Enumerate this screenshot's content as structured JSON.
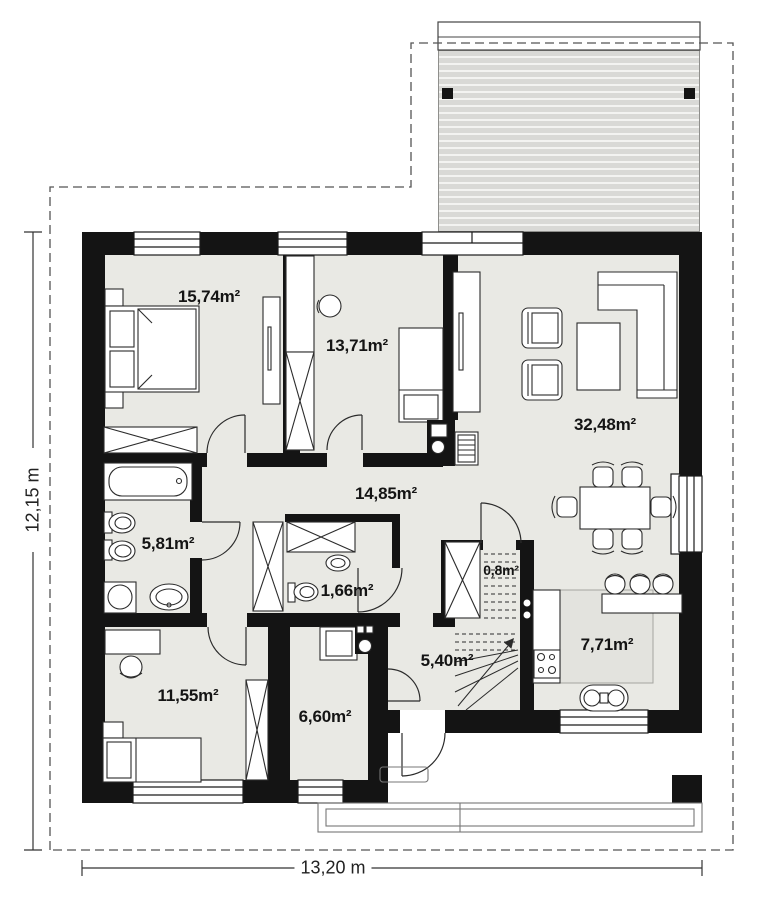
{
  "plan": {
    "type": "single-storey house floor plan",
    "total_rooms_labeled": 11
  },
  "dimensions": {
    "height": "12,15 m",
    "width": "13,20 m"
  },
  "rooms": [
    {
      "id": "bedroom-top-left",
      "area": "15,74m²"
    },
    {
      "id": "room-top-middle",
      "area": "13,71m²"
    },
    {
      "id": "living-room",
      "area": "32,48m²"
    },
    {
      "id": "hall",
      "area": "14,85m²"
    },
    {
      "id": "bathroom",
      "area": "5,81m²"
    },
    {
      "id": "wc",
      "area": "1,66m²"
    },
    {
      "id": "understairs-storage",
      "area": "0,8m²"
    },
    {
      "id": "bedroom-bottom-left",
      "area": "11,55m²"
    },
    {
      "id": "utility-room",
      "area": "6,60m²"
    },
    {
      "id": "entrance-hall",
      "area": "5,40m²"
    },
    {
      "id": "kitchen",
      "area": "7,71m²"
    }
  ],
  "colors": {
    "wall": "#141414",
    "floor": "#e9e9e4",
    "kitchen_floor": "#e3e3de",
    "terrace_stripe": "#d9d9d6",
    "outline": "#2b2b2b",
    "boundary_dash": "#555555"
  }
}
